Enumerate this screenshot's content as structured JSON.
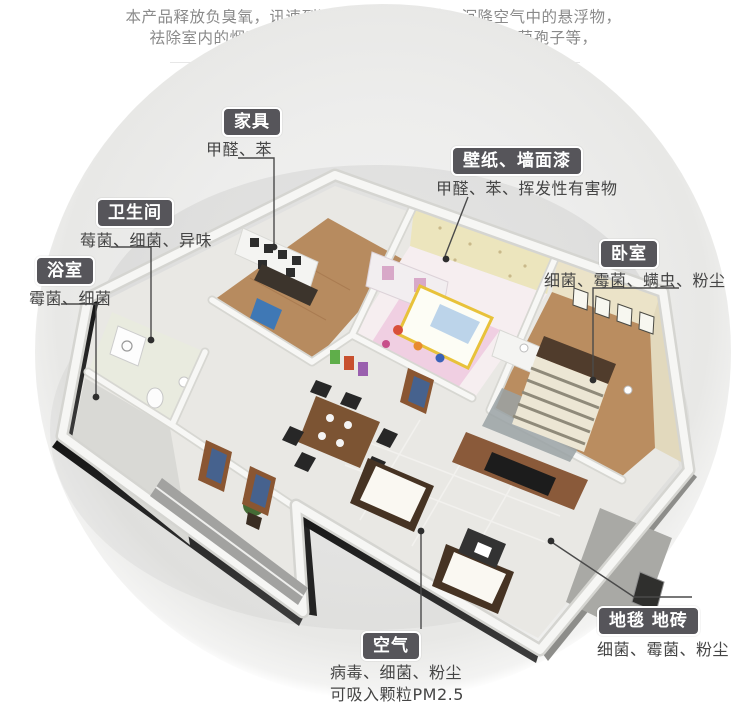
{
  "intro": {
    "lines": [
      "本产品释放负臭氧，讯速到达房间内每个角落，沉降空气中的悬浮物，",
      "祛除室内的烟味，异味，杀灭室内的细菌、病毒、霉菌孢子等，",
      "同时提升室内含氧量，使空气更为绿色清新。"
    ]
  },
  "callouts": [
    {
      "id": "furniture",
      "title": "家具",
      "desc": "甲醛、苯"
    },
    {
      "id": "wallpaper",
      "title": "壁纸、墙面漆",
      "desc": "甲醛、苯、挥发性有害物"
    },
    {
      "id": "toilet",
      "title": "卫生间",
      "desc": "莓菌、细菌、异味"
    },
    {
      "id": "bath",
      "title": "浴室",
      "desc": "霉菌、细菌"
    },
    {
      "id": "bedroom",
      "title": "卧室",
      "desc": "细菌、霉菌、螨虫、粉尘"
    },
    {
      "id": "carpet",
      "title": "地毯 地砖",
      "desc": "细菌、霉菌、粉尘"
    },
    {
      "id": "air",
      "title": "空气",
      "desc": "病毒、细菌、粉尘",
      "desc2": "可吸入颗粒PM2.5"
    }
  ],
  "colors": {
    "label_bg": "#56555a",
    "label_text": "#ffffff",
    "desc_text": "#454545",
    "intro_text": "#8a8a8a",
    "leader_line": "#4a4a4a",
    "wood_floor": "#b78b5f",
    "tile_floor": "#e9e8e4",
    "kids_wall": "#ece5bd",
    "bedroom_wall": "#ebe3c8"
  }
}
